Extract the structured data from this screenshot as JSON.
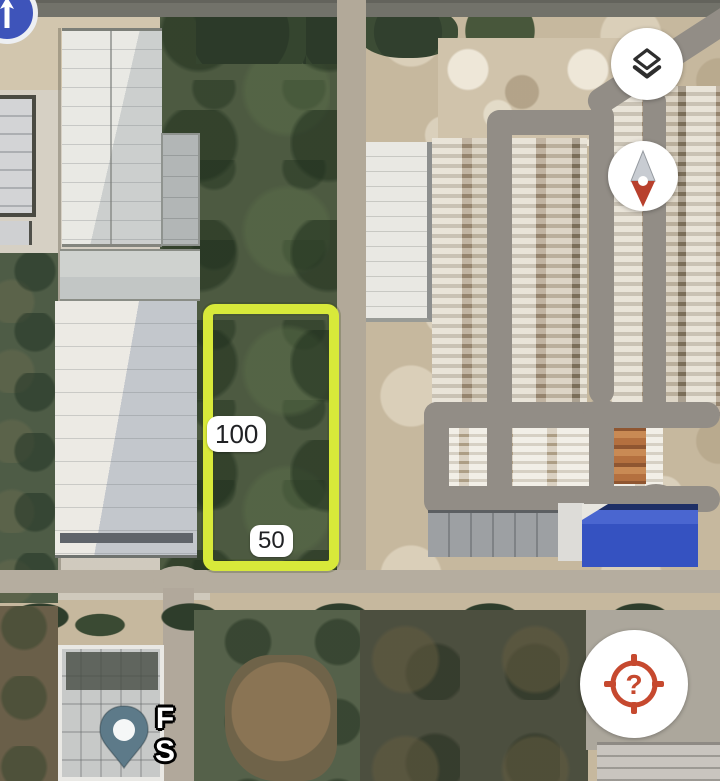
{
  "map": {
    "view": "satellite",
    "annotations": {
      "plot": {
        "length_label": "100",
        "width_label": "50",
        "outline_color": "#d8e93a"
      },
      "pin_label": {
        "line1": "F",
        "line2": "S"
      }
    },
    "colors": {
      "plot_outline": "#d8e93a",
      "pin": "#5d7a89",
      "blue_roof": "#3552c1",
      "locate_icon": "#c6492f",
      "compass_north": "#c8ccd2",
      "compass_south": "#b8402d"
    }
  },
  "controls": {
    "layers_button": {
      "icon": "layers-icon"
    },
    "compass_button": {
      "icon": "compass-needle-icon"
    },
    "locate_button": {
      "icon": "locate-target-icon",
      "glyph": "?"
    },
    "nav_button": {
      "icon": "arrow-up-icon"
    }
  }
}
